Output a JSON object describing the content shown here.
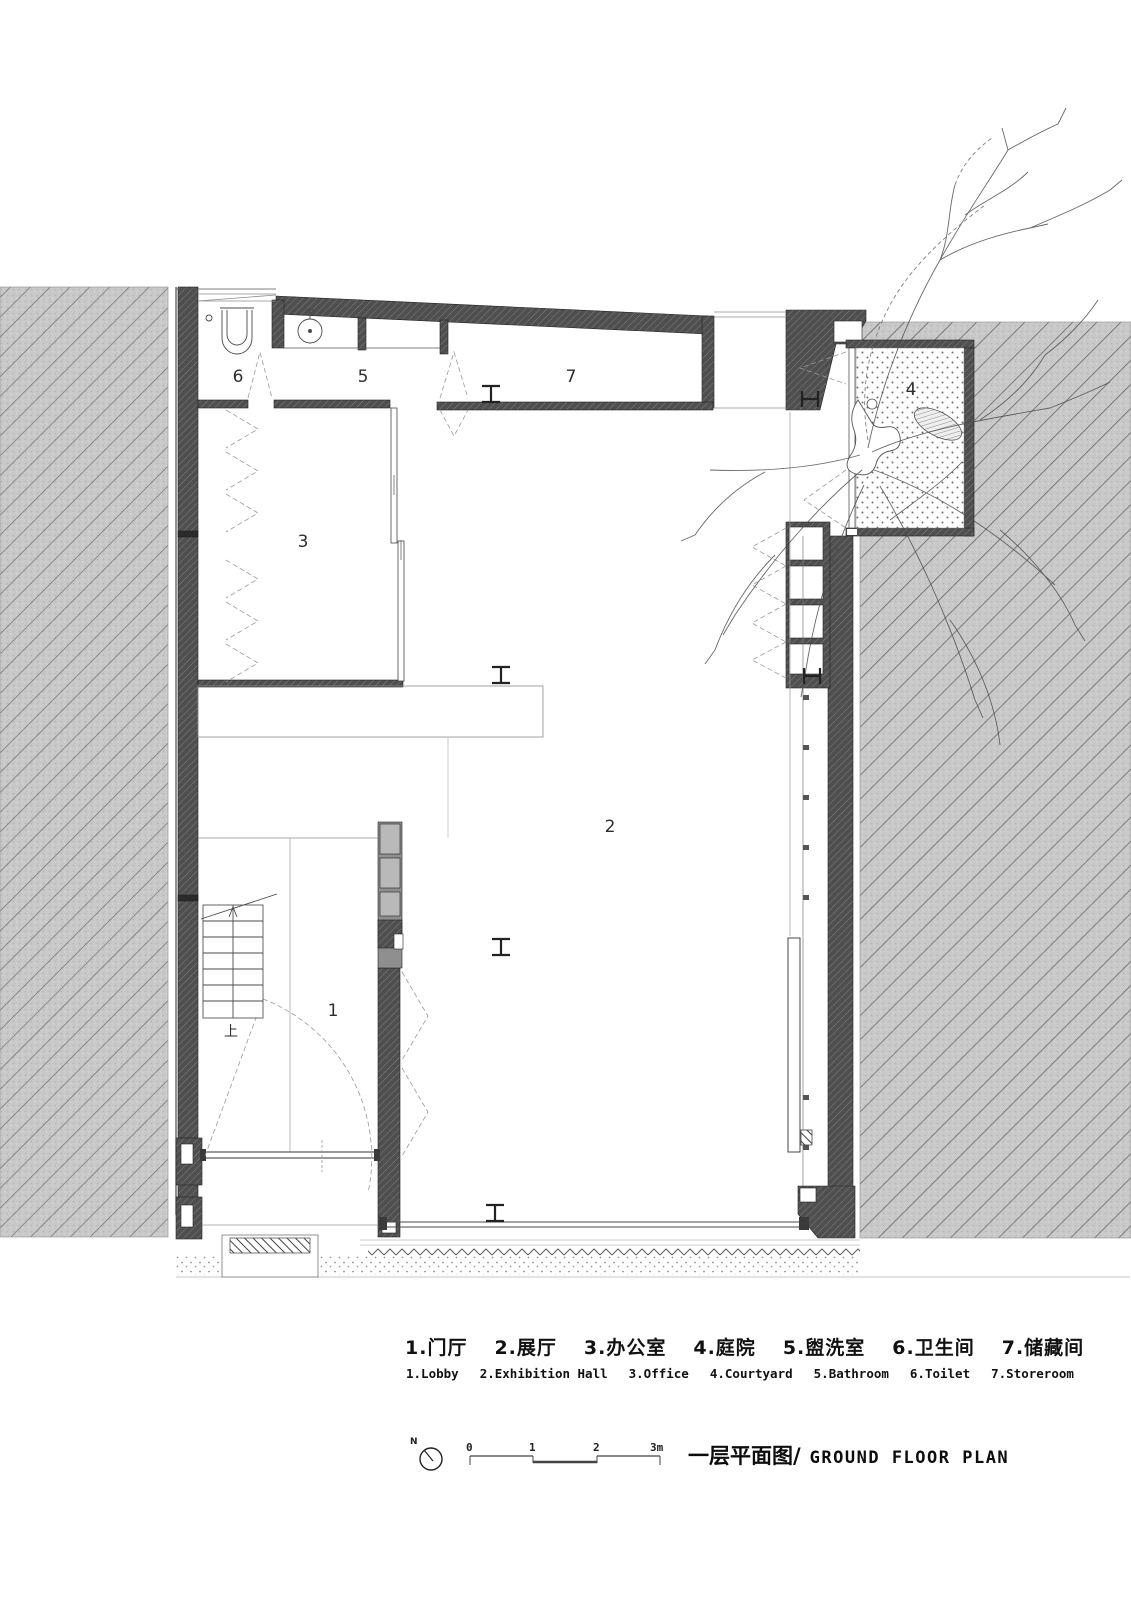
{
  "meta": {
    "drawing_type": "architectural ground floor plan"
  },
  "colors": {
    "paper": "#ffffff",
    "ink": "#2b2b2b",
    "wall_cut_fill": "#4f4f4f",
    "neighbor_block_fill": "#c9c9c9",
    "cabinet_gray": "#b5b5b5"
  },
  "rooms": [
    {
      "number": "1",
      "name_zh": "门厅",
      "name_en": "Lobby"
    },
    {
      "number": "2",
      "name_zh": "展厅",
      "name_en": "Exhibition Hall"
    },
    {
      "number": "3",
      "name_zh": "办公室",
      "name_en": "Office"
    },
    {
      "number": "4",
      "name_zh": "庭院",
      "name_en": "Courtyard"
    },
    {
      "number": "5",
      "name_zh": "盥洗室",
      "name_en": "Bathroom"
    },
    {
      "number": "6",
      "name_zh": "卫生间",
      "name_en": "Toilet"
    },
    {
      "number": "7",
      "name_zh": "储藏间",
      "name_en": "Storeroom"
    }
  ],
  "plan": {
    "stair_up_label": "上"
  },
  "legend": {
    "items": [
      {
        "zh": "1.门厅",
        "en": "1.Lobby"
      },
      {
        "zh": "2.展厅",
        "en": "2.Exhibition Hall"
      },
      {
        "zh": "3.办公室",
        "en": "3.Office"
      },
      {
        "zh": "4.庭院",
        "en": "4.Courtyard"
      },
      {
        "zh": "5.盥洗室",
        "en": "5.Bathroom"
      },
      {
        "zh": "6.卫生间",
        "en": "6.Toilet"
      },
      {
        "zh": "7.储藏间",
        "en": "7.Storeroom"
      }
    ]
  },
  "titleblock": {
    "north_label": "N",
    "scale_ticks": [
      "0",
      "1",
      "2",
      "3m"
    ],
    "title_zh": "一层平面图/",
    "title_en": "GROUND FLOOR PLAN"
  }
}
